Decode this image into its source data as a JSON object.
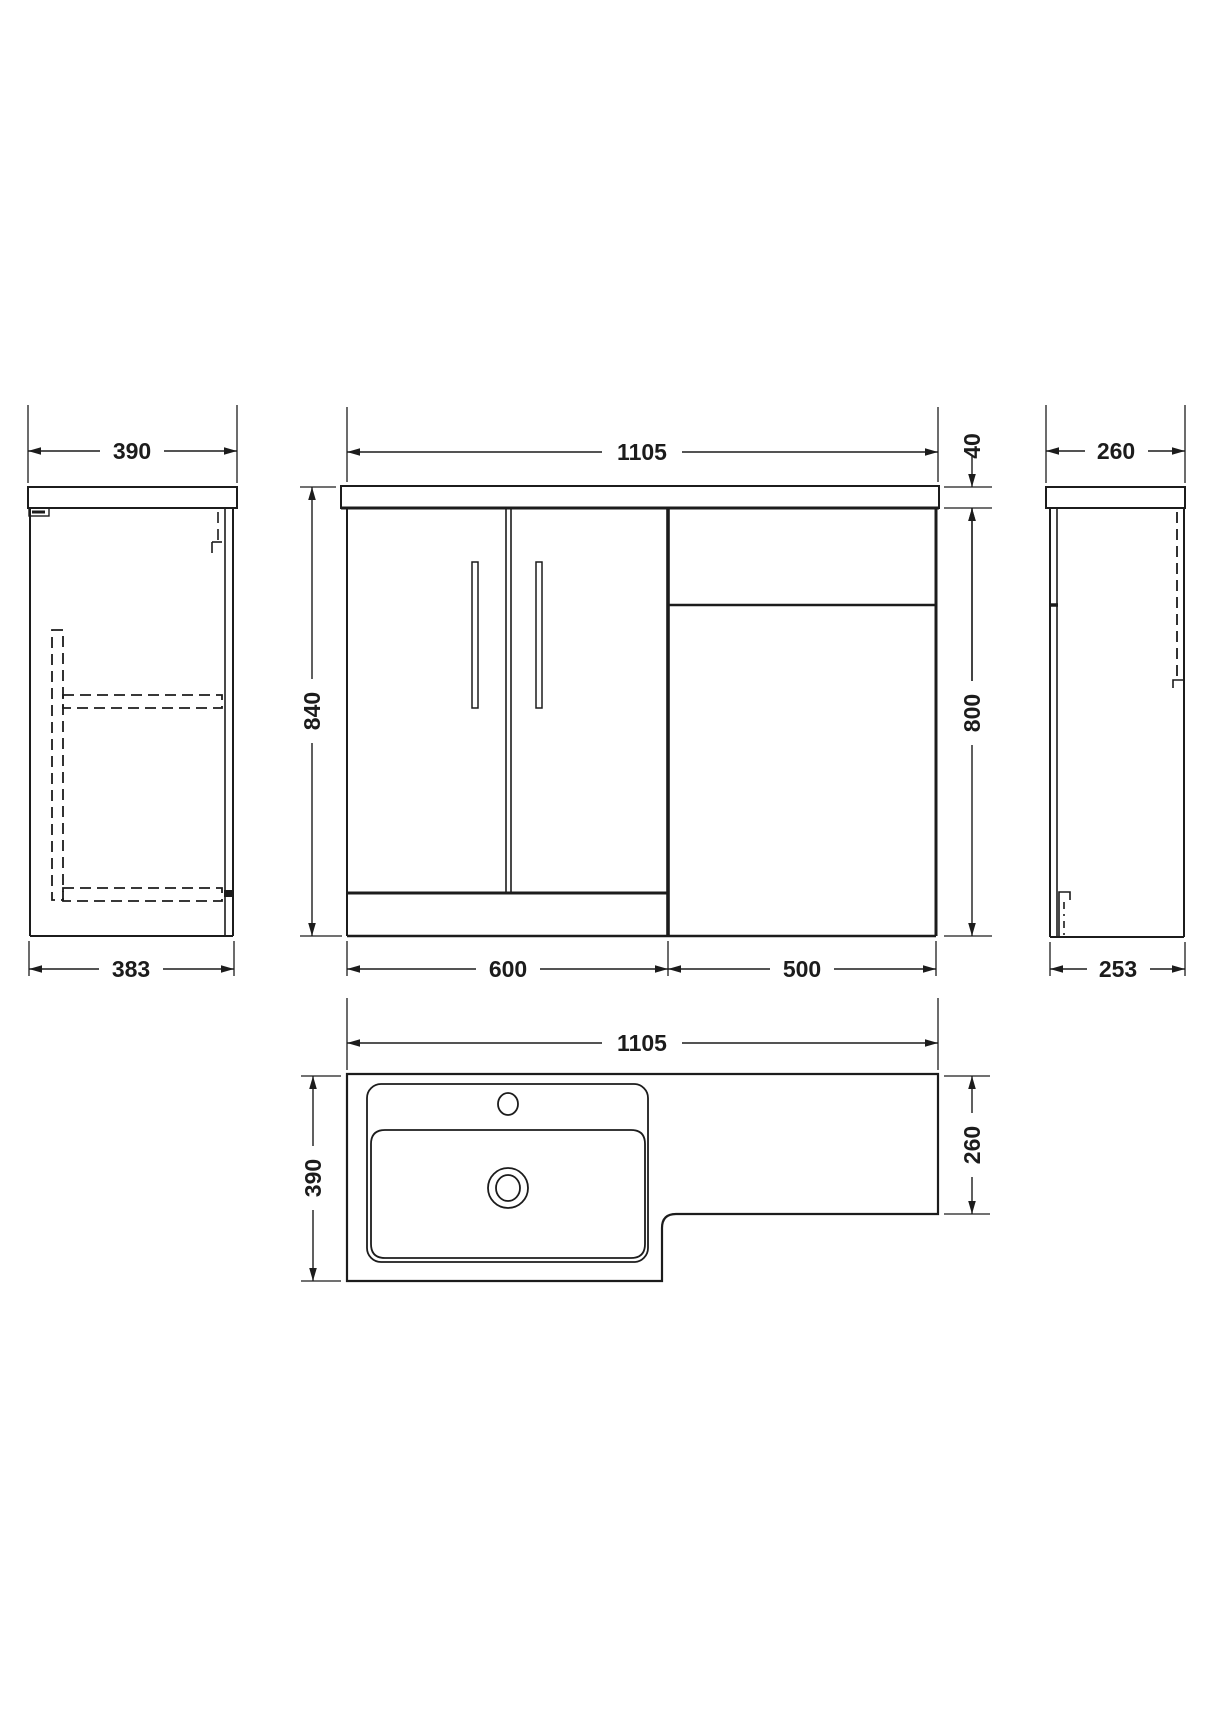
{
  "drawing": {
    "type": "technical-dimension-drawing",
    "subject": "L-shaped bathroom combination vanity basin and WC unit",
    "colors": {
      "line": "#1c1c1c",
      "background": "#ffffff"
    },
    "views": {
      "left_side": {
        "width_top": "390",
        "width_bottom": "383"
      },
      "front": {
        "width": "1105",
        "worktop_thickness": "40",
        "height_total": "840",
        "height_cabinet": "800",
        "width_vanity": "600",
        "width_wc": "500"
      },
      "right_side": {
        "depth_top": "260",
        "depth_bottom": "253"
      },
      "plan": {
        "width": "1105",
        "depth": "390",
        "depth_wc": "260"
      }
    }
  }
}
